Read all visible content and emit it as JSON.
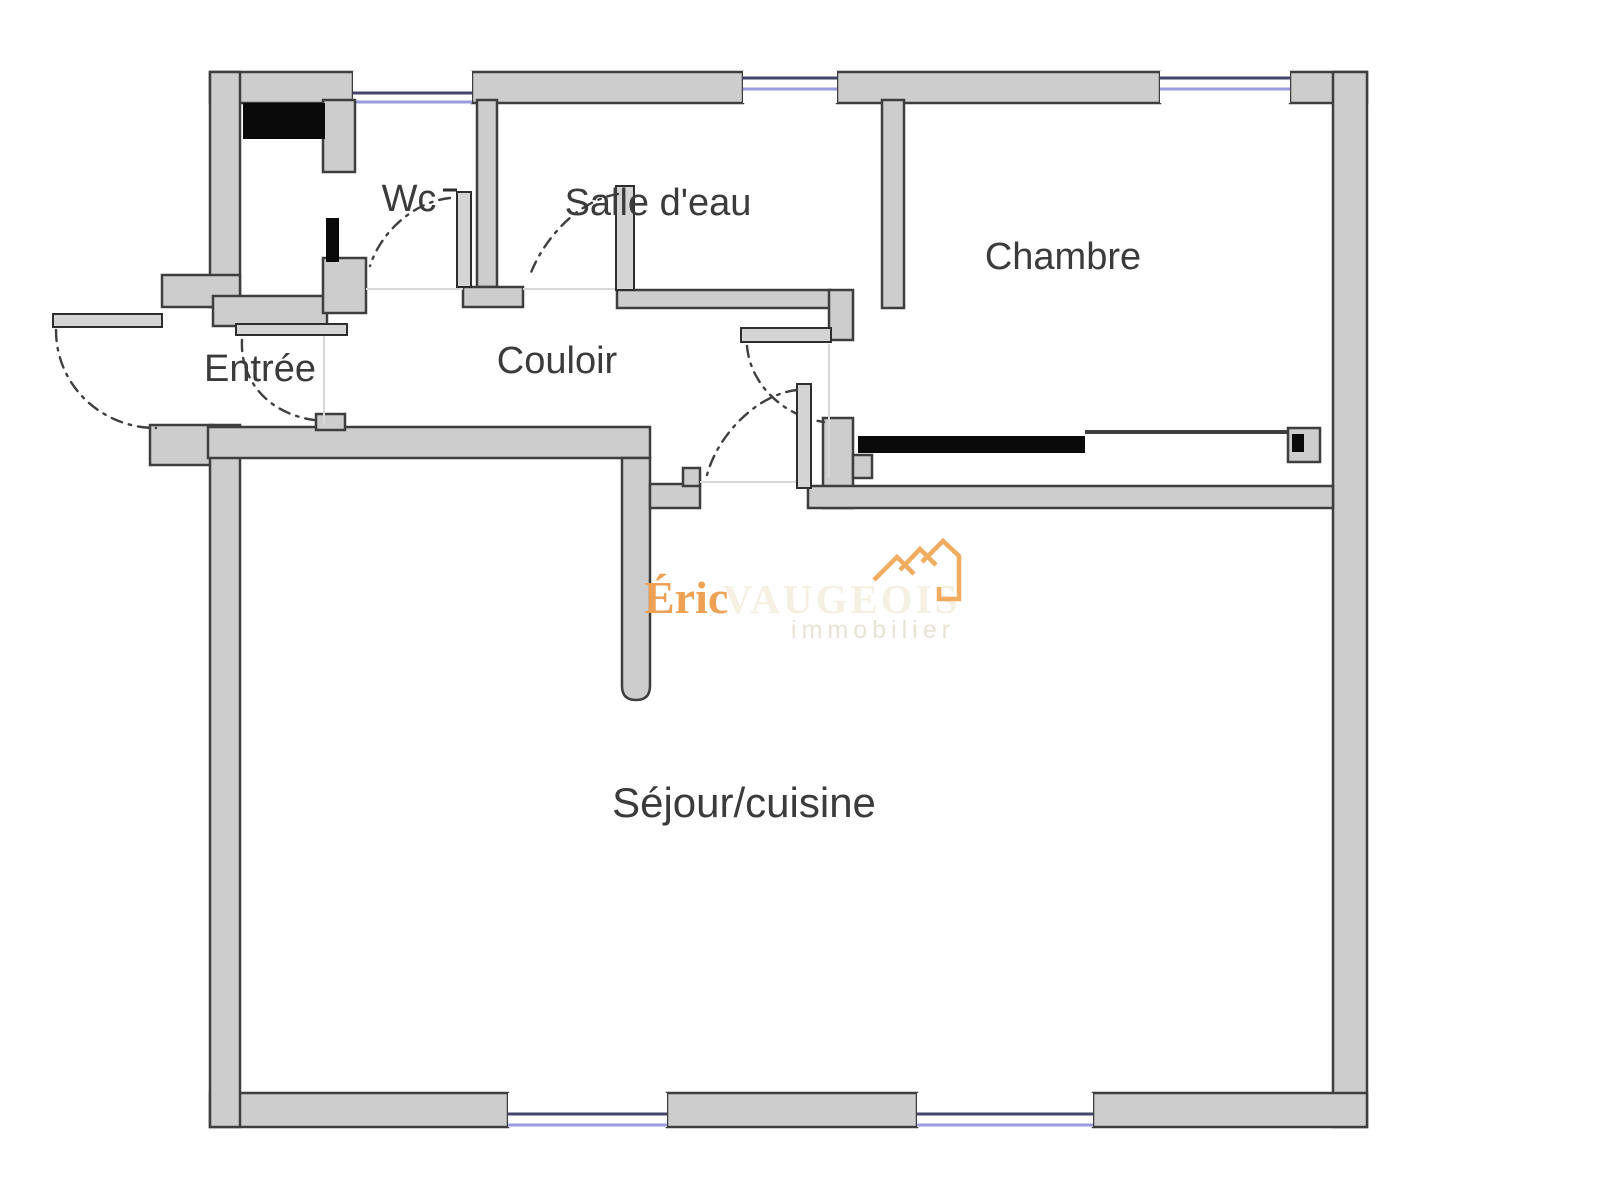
{
  "plan": {
    "rooms": [
      {
        "id": "entree",
        "label": "Entrée"
      },
      {
        "id": "wc",
        "label": "Wc"
      },
      {
        "id": "salle_deau",
        "label": "Salle d'eau"
      },
      {
        "id": "couloir",
        "label": "Couloir"
      },
      {
        "id": "chambre",
        "label": "Chambre"
      },
      {
        "id": "sejour",
        "label": "Séjour/cuisine"
      }
    ],
    "features": {
      "windows": 5,
      "doors_with_swing_arcs": 6,
      "black_fixtures": [
        "duct-box",
        "closet-door-panel",
        "wardrobe-sliding-door"
      ]
    }
  },
  "watermark": {
    "brand_first": "Éric",
    "brand_name": "VAUGEOIS",
    "tagline": "immobilier"
  },
  "colors": {
    "wall_fill": "#cdcdcd",
    "wall_stroke": "#3e3e3e",
    "black": "#0a0a0a",
    "window_frame_dark": "#45456b",
    "window_glass": "#9a9ade",
    "floor_line": "#d9d9d9",
    "label": "#3b3b3b",
    "door_fill": "#d4d4d4",
    "arc": "#3f3f3f",
    "wm_first": "#eea154",
    "wm_name": "#f6f0e2",
    "wm_tagline": "#e8e3d5",
    "wm_roof": "#f1ac60",
    "background": "#ffffff"
  }
}
